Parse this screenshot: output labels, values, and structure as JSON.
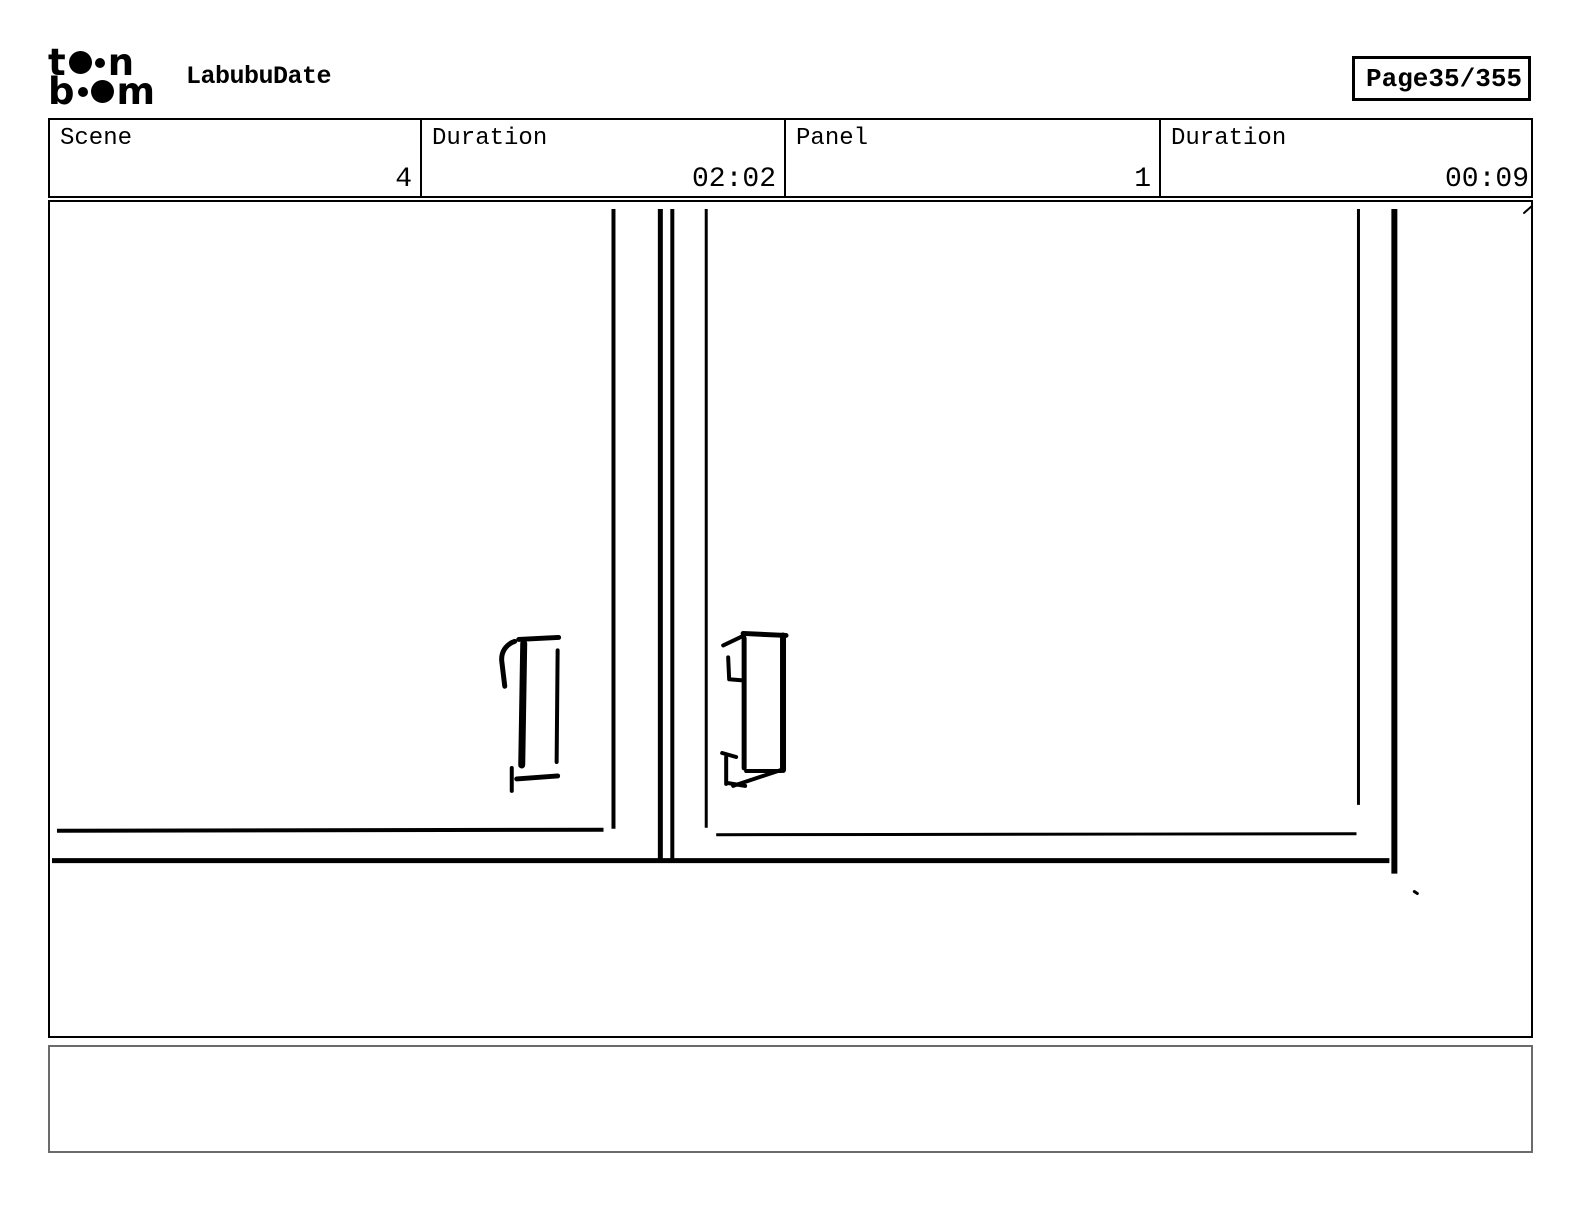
{
  "header": {
    "logo": {
      "l1a": "t",
      "l1b": "n",
      "l2a": "b",
      "l2b": "m"
    },
    "title": "LabubuDate",
    "page_label": "Page",
    "page_value": "35/355"
  },
  "info_row": {
    "cells": [
      {
        "label": "Scene",
        "value": "4"
      },
      {
        "label": "Duration",
        "value": "02:02"
      },
      {
        "label": "Panel",
        "value": "1"
      },
      {
        "label": "Duration",
        "value": "00:09"
      }
    ]
  },
  "panel": {
    "caption": ""
  },
  "colors": {
    "ink": "#000000",
    "paper": "#ffffff",
    "caption_border": "#6b6b6b"
  },
  "sketch": {
    "viewBox": "48 200 1485 837",
    "strokes": [
      {
        "d": "M613,207 L613,829",
        "w": 4
      },
      {
        "d": "M660,207 L660,861",
        "w": 5
      },
      {
        "d": "M672,207 L672,861",
        "w": 4
      },
      {
        "d": "M706,207 L706,828",
        "w": 3
      },
      {
        "d": "M1360,207 L1360,805",
        "w": 3
      },
      {
        "d": "M1396,207 L1396,874",
        "w": 6
      },
      {
        "d": "M55,831 L603,830",
        "w": 4
      },
      {
        "d": "M716,835 L1358,834",
        "w": 3
      },
      {
        "d": "M50,861 L1391,861",
        "w": 5
      },
      {
        "d": "M518,639 L558,637",
        "w": 5,
        "cap": "round"
      },
      {
        "d": "M514,641 C505,644 500,652 501,661 L504,686",
        "w": 5,
        "cap": "round"
      },
      {
        "d": "M523,643 L521,765",
        "w": 7,
        "cap": "round"
      },
      {
        "d": "M557,650 L556,762",
        "w": 4,
        "cap": "round"
      },
      {
        "d": "M511,768 L511,791",
        "w": 4,
        "cap": "round"
      },
      {
        "d": "M516,779 L557,776",
        "w": 5,
        "cap": "round"
      },
      {
        "d": "M743,633 L786,635",
        "w": 5,
        "cap": "round"
      },
      {
        "d": "M723,645 L744,635",
        "w": 4,
        "cap": "round"
      },
      {
        "d": "M744,638 L744,768",
        "w": 5,
        "cap": "round"
      },
      {
        "d": "M783,635 L783,770",
        "w": 6,
        "cap": "round"
      },
      {
        "d": "M728,657 L729,679 L741,680",
        "w": 4,
        "cap": "round"
      },
      {
        "d": "M722,753 L736,757",
        "w": 4,
        "cap": "round"
      },
      {
        "d": "M726,757 L726,784",
        "w": 4,
        "cap": "round"
      },
      {
        "d": "M727,783 L745,786",
        "w": 4,
        "cap": "round"
      },
      {
        "d": "M746,771 L781,771",
        "w": 4,
        "cap": "round"
      },
      {
        "d": "M733,786 L784,769",
        "w": 4,
        "cap": "round"
      },
      {
        "d": "M1526,211 L1534,204",
        "w": 2,
        "cap": "round"
      },
      {
        "d": "M1416,892 L1419,894",
        "w": 3,
        "cap": "round"
      }
    ]
  }
}
